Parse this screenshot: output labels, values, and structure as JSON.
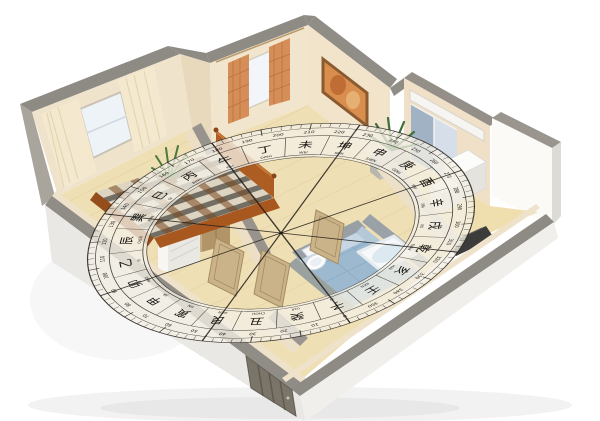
{
  "scene": {
    "description": "3D cutaway render of a one-bedroom apartment viewed isometrically from above, with a feng shui luopan compass overlaid semi-transparently on the floor",
    "background_color": "#ffffff"
  },
  "palette": {
    "wall_top_gray": "#8e8a84",
    "wall_exterior": "#e9e8e4",
    "wall_interior_cream": "#f0e3cb",
    "floor_wood": "#ead7a4",
    "floor_balcony": "#f0dfae",
    "bathroom_floor_blue": "#9cb9d0",
    "bathroom_wall_blue": "#c6d6e4",
    "curtain_cream": "#f4e9cf",
    "curtain_orange": "#d4874f",
    "bed_plaid_dark": "#2e2a26",
    "bed_plaid_brown": "#7a4a22",
    "bed_frame_wood": "#a8571f",
    "interior_door_wood": "#cbb389",
    "entry_door_gray": "#7b7469",
    "plant_green": "#4a7a3a",
    "compass_band": "rgba(244,240,230,0.78)",
    "compass_line": "#2a2620",
    "compass_text": "#16130f"
  },
  "compass": {
    "mountains": [
      {
        "char": "丁",
        "pinyin": "DING"
      },
      {
        "char": "未",
        "pinyin": "WEI"
      },
      {
        "char": "坤",
        "pinyin": "KUN"
      },
      {
        "char": "申",
        "pinyin": "SHEN"
      },
      {
        "char": "庚",
        "pinyin": "GENG"
      },
      {
        "char": "酉",
        "pinyin": "YOU"
      },
      {
        "char": "辛",
        "pinyin": "XIN"
      },
      {
        "char": "戌",
        "pinyin": "XU"
      },
      {
        "char": "乾",
        "pinyin": "QIAN"
      },
      {
        "char": "亥",
        "pinyin": "HAI"
      },
      {
        "char": "壬",
        "pinyin": "REN"
      },
      {
        "char": "子",
        "pinyin": "ZI"
      },
      {
        "char": "癸",
        "pinyin": "GUI"
      },
      {
        "char": "丑",
        "pinyin": "CHOU"
      },
      {
        "char": "艮",
        "pinyin": "GEN"
      },
      {
        "char": "寅",
        "pinyin": "YIN"
      },
      {
        "char": "甲",
        "pinyin": "JIA"
      },
      {
        "char": "卯",
        "pinyin": "MAO"
      },
      {
        "char": "乙",
        "pinyin": "YI"
      },
      {
        "char": "辰",
        "pinyin": "CHEN"
      },
      {
        "char": "巽",
        "pinyin": "XUN"
      },
      {
        "char": "巳",
        "pinyin": "SI"
      },
      {
        "char": "丙",
        "pinyin": "BING"
      },
      {
        "char": "午",
        "pinyin": "WU"
      }
    ],
    "degree_labels": [
      0,
      10,
      20,
      30,
      40,
      50,
      60,
      70,
      80,
      90,
      100,
      110,
      120,
      130,
      140,
      150,
      160,
      170,
      180,
      190,
      200,
      210,
      220,
      230,
      240,
      250,
      260,
      270,
      280,
      290,
      300,
      310,
      320,
      330,
      340,
      350
    ],
    "spoke_count": 8
  }
}
